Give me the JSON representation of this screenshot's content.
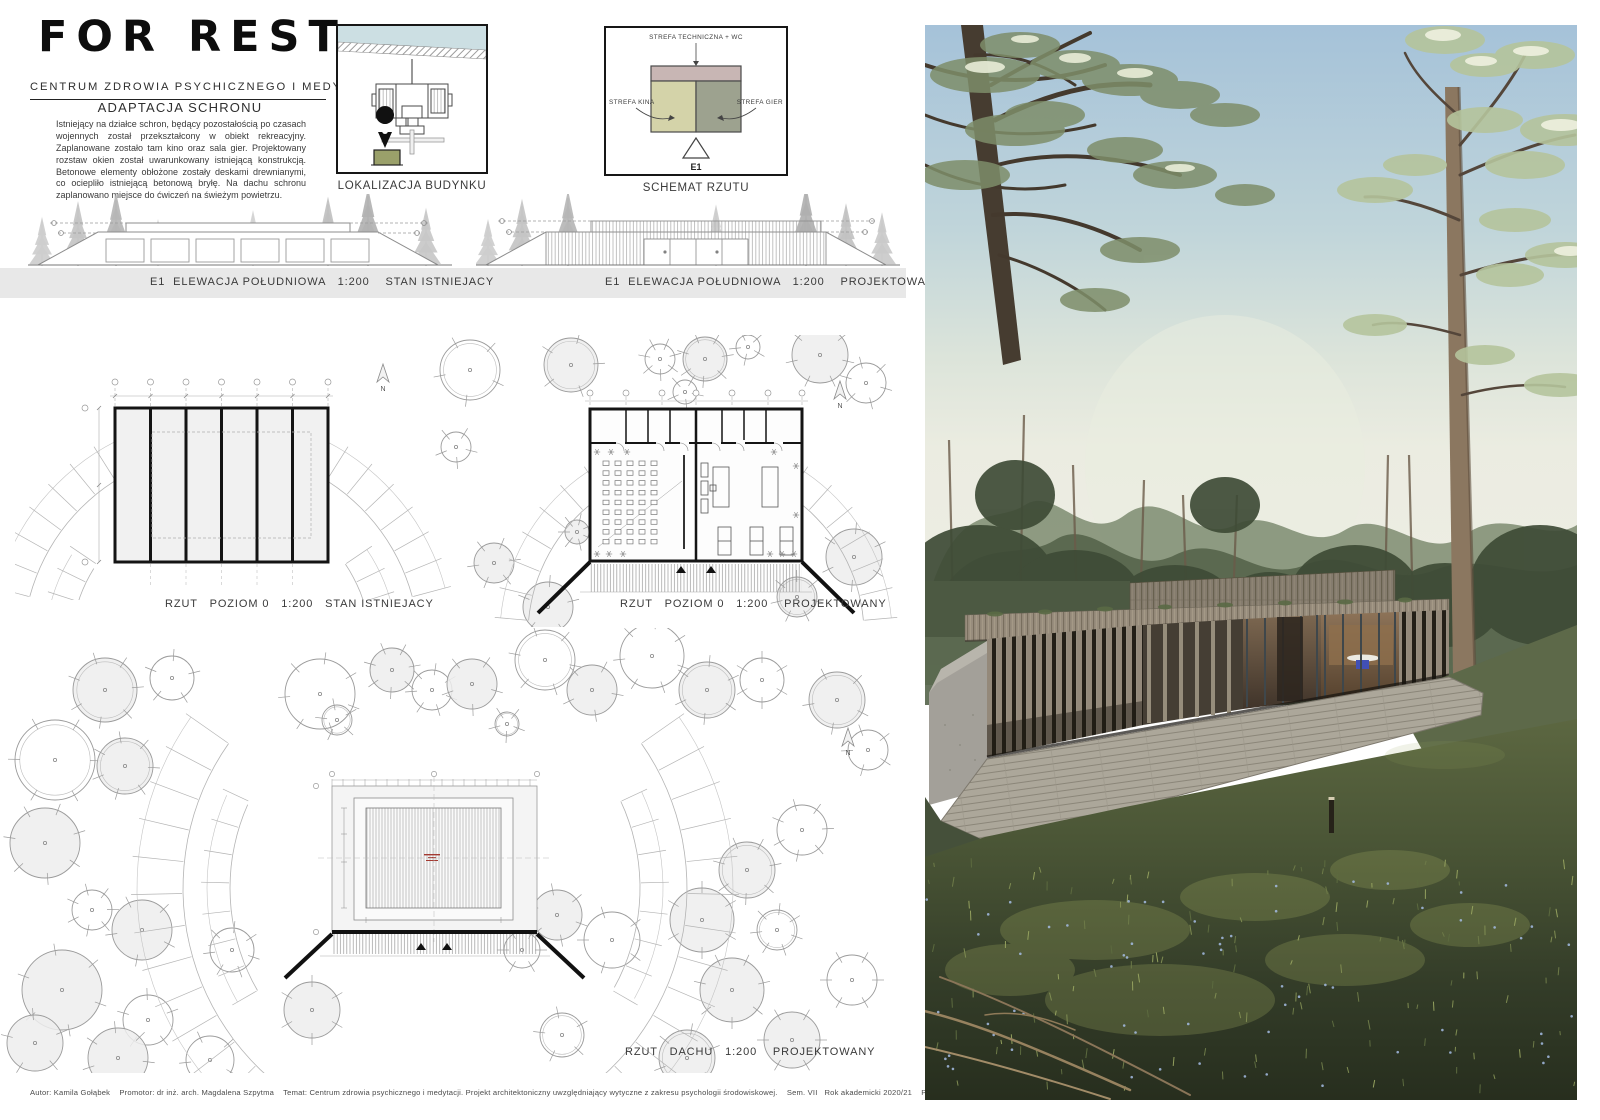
{
  "logo": {
    "title": "FOR REST",
    "subtitle": "CENTRUM ZDROWIA PSYCHICZNEGO I MEDYTACJI"
  },
  "intro": {
    "heading": "ADAPTACJA SCHRONU",
    "body": "Istniejący na działce schron, będący pozostałością po czasach wojennych został przekształcony w obiekt rekreacyjny. Zaplanowane zostało tam kino oraz sala gier. Projektowany rozstaw okien został uwarunkowany istniejącą konstrukcją. Betonowe elementy obłożone zostały deskami drewnianymi, co ociepliło istniejącą betonową bryłę. Na dachu schronu zaplanowano miejsce do ćwiczeń na świeżym powietrzu."
  },
  "location_diagram": {
    "caption": "LOKALIZACJA BUDYNKU"
  },
  "schema_diagram": {
    "caption": "SCHEMAT RZUTU",
    "zones": {
      "technical": "STREFA TECHNICZNA + WC",
      "cinema": "STREFA KINA",
      "games": "STREFA GIER"
    },
    "elevation_marker": "E1",
    "colors": {
      "technical": "#c8b6b4",
      "cinema": "#d4d3a9",
      "games": "#9da28f"
    }
  },
  "labels": {
    "elevation_existing": "E1  ELEWACJA POŁUDNIOWA   1:200    STAN ISTNIEJACY",
    "elevation_designed": "E1  ELEWACJA POŁUDNIOWA   1:200    PROJEKTOWANA",
    "plan_existing": "RZUT   POZIOM 0   1:200   STAN ISTNIEJACY",
    "plan_designed": "RZUT   POZIOM 0   1:200    PROJEKTOWANY",
    "roof_plan": "RZUT   DACHU   1:200    PROJEKTOWANY",
    "north": "N"
  },
  "footer": {
    "text": "Autor: Kamila Gołąbek    Promotor: dr inż. arch. Magdalena Szpytma    Temat: Centrum zdrowia psychicznego i medytacji. Projekt architektoniczny uwzględniający wytyczne z zakresu psychologii środowiskowej.    Sem. VII   Rok akademicki 2020/21    Politechnika Rzeszowska   Plansza 6"
  }
}
